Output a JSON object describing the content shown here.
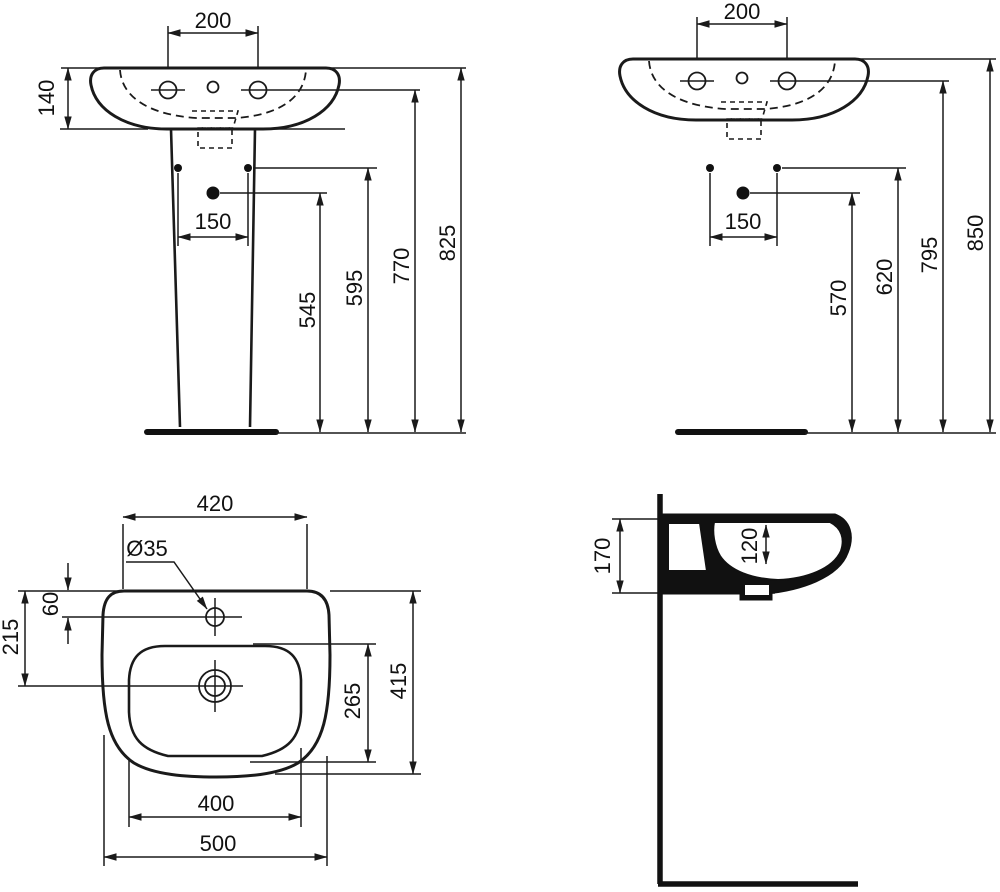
{
  "drawing": {
    "type": "sanitaryware installation drawing",
    "subject": "pedestal washbasin with dimensions",
    "units": "mm"
  },
  "colors": {
    "line": "#1a1a1a",
    "background": "#ffffff"
  },
  "views": {
    "front_pedestal": {
      "name": "front view with pedestal",
      "dims": {
        "tap_spacing": "200",
        "basin_apron_height": "140",
        "fixing_hole_spacing": "150",
        "drain_height": "545",
        "fixing_height": "595",
        "tap_height": "770",
        "rim_height": "825"
      }
    },
    "front_wall_hung": {
      "name": "front view wall hung",
      "dims": {
        "tap_spacing": "200",
        "fixing_hole_spacing": "150",
        "drain_height": "570",
        "fixing_height": "620",
        "tap_height": "795",
        "rim_height": "850"
      }
    },
    "plan": {
      "name": "plan view",
      "dims": {
        "rear_width": "420",
        "tap_hole_diameter": "Ø35",
        "tap_hole_offset": "60",
        "drain_offset": "215",
        "bowl_depth": "265",
        "overall_depth": "415",
        "bowl_width": "400",
        "overall_width": "500"
      }
    },
    "side": {
      "name": "side section view",
      "dims": {
        "basin_height": "170",
        "bowl_inner_depth": "120"
      }
    }
  }
}
